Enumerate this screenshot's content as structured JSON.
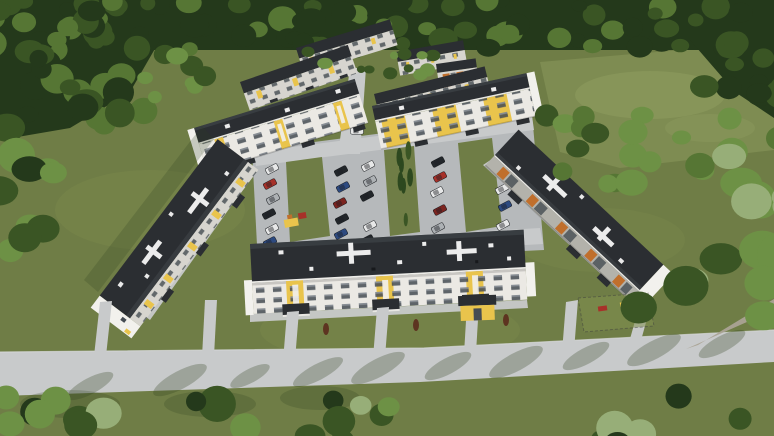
{
  "scene": {
    "description": "Aerial 3D architectural rendering of a residential estate: apartment blocks with dark flat roofs, white facades with yellow accents, central parking courtyard with cars, lawns, footpaths, an access road and surrounding forest"
  },
  "palette": {
    "lawn": "#6f7d46",
    "lawn_light": "#81904f",
    "meadow": "#7e8c52",
    "forest_dark": "#24391b",
    "forest_mid": "#3a5524",
    "forest_light": "#567634",
    "tree_bright": "#6d9145",
    "tree_pale": "#97ae78",
    "conifer": "#2d481f",
    "road": "#c8cacb",
    "asphalt": "#b6b9bb",
    "path_gravel": "#aaa395",
    "roof": "#2b2e32",
    "roof_edge": "#464b50",
    "facade": "#ebe9e4",
    "facade_shade": "#d7d5cf",
    "facade_dark": "#b3b2ab",
    "window": "#454c53",
    "accent_yellow": "#e9c44c",
    "accent_orange": "#c06f2c",
    "shadow": "#2f3f1e",
    "car_white": "#e7e8e8",
    "car_silver": "#adb1b4",
    "car_black": "#22262a",
    "car_red": "#a73129",
    "car_blue": "#2d4a80",
    "car_darkred": "#7c241f"
  },
  "vegetation": [
    {
      "n": "top-forest",
      "s": 11,
      "c": 80,
      "x0": -12,
      "x1": 786,
      "y0": 0,
      "y1": 50,
      "r0": 7,
      "r1": 15,
      "cols": [
        "forest_dark",
        "forest_mid",
        "forest_light"
      ],
      "l": "veg-back"
    },
    {
      "n": "forest-left-deep",
      "s": 7,
      "c": 26,
      "x0": -12,
      "x1": 150,
      "y0": 38,
      "y1": 125,
      "r0": 9,
      "r1": 17,
      "cols": [
        "forest_dark",
        "forest_mid",
        "forest_light"
      ],
      "l": "veg-back"
    },
    {
      "n": "forest-right-corner",
      "s": 31,
      "c": 12,
      "x0": 700,
      "x1": 790,
      "y0": 40,
      "y1": 105,
      "r0": 9,
      "r1": 16,
      "cols": [
        "forest_dark",
        "forest_mid"
      ],
      "l": "veg-back"
    },
    {
      "n": "left-meadow-trees",
      "s": 9,
      "c": 8,
      "x0": 140,
      "x1": 215,
      "y0": 52,
      "y1": 105,
      "r0": 6,
      "r1": 12,
      "cols": [
        "forest_mid",
        "tree_bright"
      ],
      "l": "veg-back"
    },
    {
      "n": "courtyard-back-trees",
      "s": 23,
      "c": 12,
      "x0": 295,
      "x1": 435,
      "y0": 50,
      "y1": 76,
      "r0": 4,
      "r1": 8,
      "cols": [
        "forest_mid",
        "tree_bright"
      ],
      "l": "veg-court"
    },
    {
      "n": "left-edge-trees",
      "s": 5,
      "c": 11,
      "x0": -10,
      "x1": 58,
      "y0": 125,
      "y1": 265,
      "r0": 10,
      "r1": 20,
      "cols": [
        "forest_mid",
        "forest_dark",
        "tree_bright"
      ],
      "l": "veg-mid"
    },
    {
      "n": "right-meadow-bushes",
      "s": 13,
      "c": 20,
      "x0": 545,
      "x1": 786,
      "y0": 108,
      "y1": 190,
      "r0": 9,
      "r1": 17,
      "cols": [
        "tree_bright",
        "forest_mid",
        "forest_light"
      ],
      "l": "veg-mid"
    },
    {
      "n": "right-edge-trees",
      "s": 17,
      "c": 15,
      "x0": 628,
      "x1": 795,
      "y0": 148,
      "y1": 330,
      "r0": 14,
      "r1": 27,
      "cols": [
        "tree_bright",
        "forest_mid",
        "tree_pale"
      ],
      "l": "veg-mid"
    },
    {
      "n": "center-conifers",
      "s": 29,
      "c": 7,
      "x0": 398,
      "x1": 414,
      "y0": 150,
      "y1": 250,
      "r0": 4,
      "r1": 7,
      "cols": [
        "conifer",
        "forest_mid"
      ],
      "sh": "conifer",
      "l": "veg-mid"
    },
    {
      "n": "bottom-bushes",
      "s": 19,
      "c": 24,
      "x0": -12,
      "x1": 786,
      "y0": 396,
      "y1": 444,
      "r0": 10,
      "r1": 20,
      "cols": [
        "tree_pale",
        "forest_mid",
        "tree_bright",
        "forest_dark"
      ],
      "l": "veg-front"
    }
  ],
  "cars": [
    [
      272,
      169,
      -28,
      "car_white"
    ],
    [
      270,
      184,
      -28,
      "car_red"
    ],
    [
      273,
      199,
      -28,
      "car_silver"
    ],
    [
      269,
      214,
      -28,
      "car_black"
    ],
    [
      272,
      229,
      -28,
      "car_white"
    ],
    [
      270,
      242,
      -28,
      "car_blue"
    ],
    [
      341,
      171,
      -28,
      "car_black"
    ],
    [
      343,
      187,
      -28,
      "car_blue"
    ],
    [
      340,
      203,
      -28,
      "car_darkred"
    ],
    [
      342,
      219,
      -28,
      "car_black"
    ],
    [
      341,
      234,
      -28,
      "car_blue"
    ],
    [
      368,
      166,
      -28,
      "car_white"
    ],
    [
      370,
      181,
      -28,
      "car_silver"
    ],
    [
      367,
      196,
      -28,
      "car_black"
    ],
    [
      370,
      226,
      -28,
      "car_white"
    ],
    [
      367,
      240,
      -28,
      "car_black"
    ],
    [
      438,
      162,
      -28,
      "car_black"
    ],
    [
      440,
      177,
      -28,
      "car_red"
    ],
    [
      437,
      192,
      -28,
      "car_white"
    ],
    [
      440,
      210,
      -28,
      "car_darkred"
    ],
    [
      438,
      228,
      -28,
      "car_silver"
    ],
    [
      503,
      158,
      -28,
      "car_black"
    ],
    [
      506,
      173,
      -28,
      "car_red"
    ],
    [
      502,
      189,
      -28,
      "car_white"
    ],
    [
      505,
      206,
      -28,
      "car_blue"
    ],
    [
      503,
      225,
      -28,
      "car_white"
    ],
    [
      357,
      131,
      0,
      "car_white"
    ],
    [
      420,
      117,
      -10,
      "car_silver"
    ]
  ]
}
